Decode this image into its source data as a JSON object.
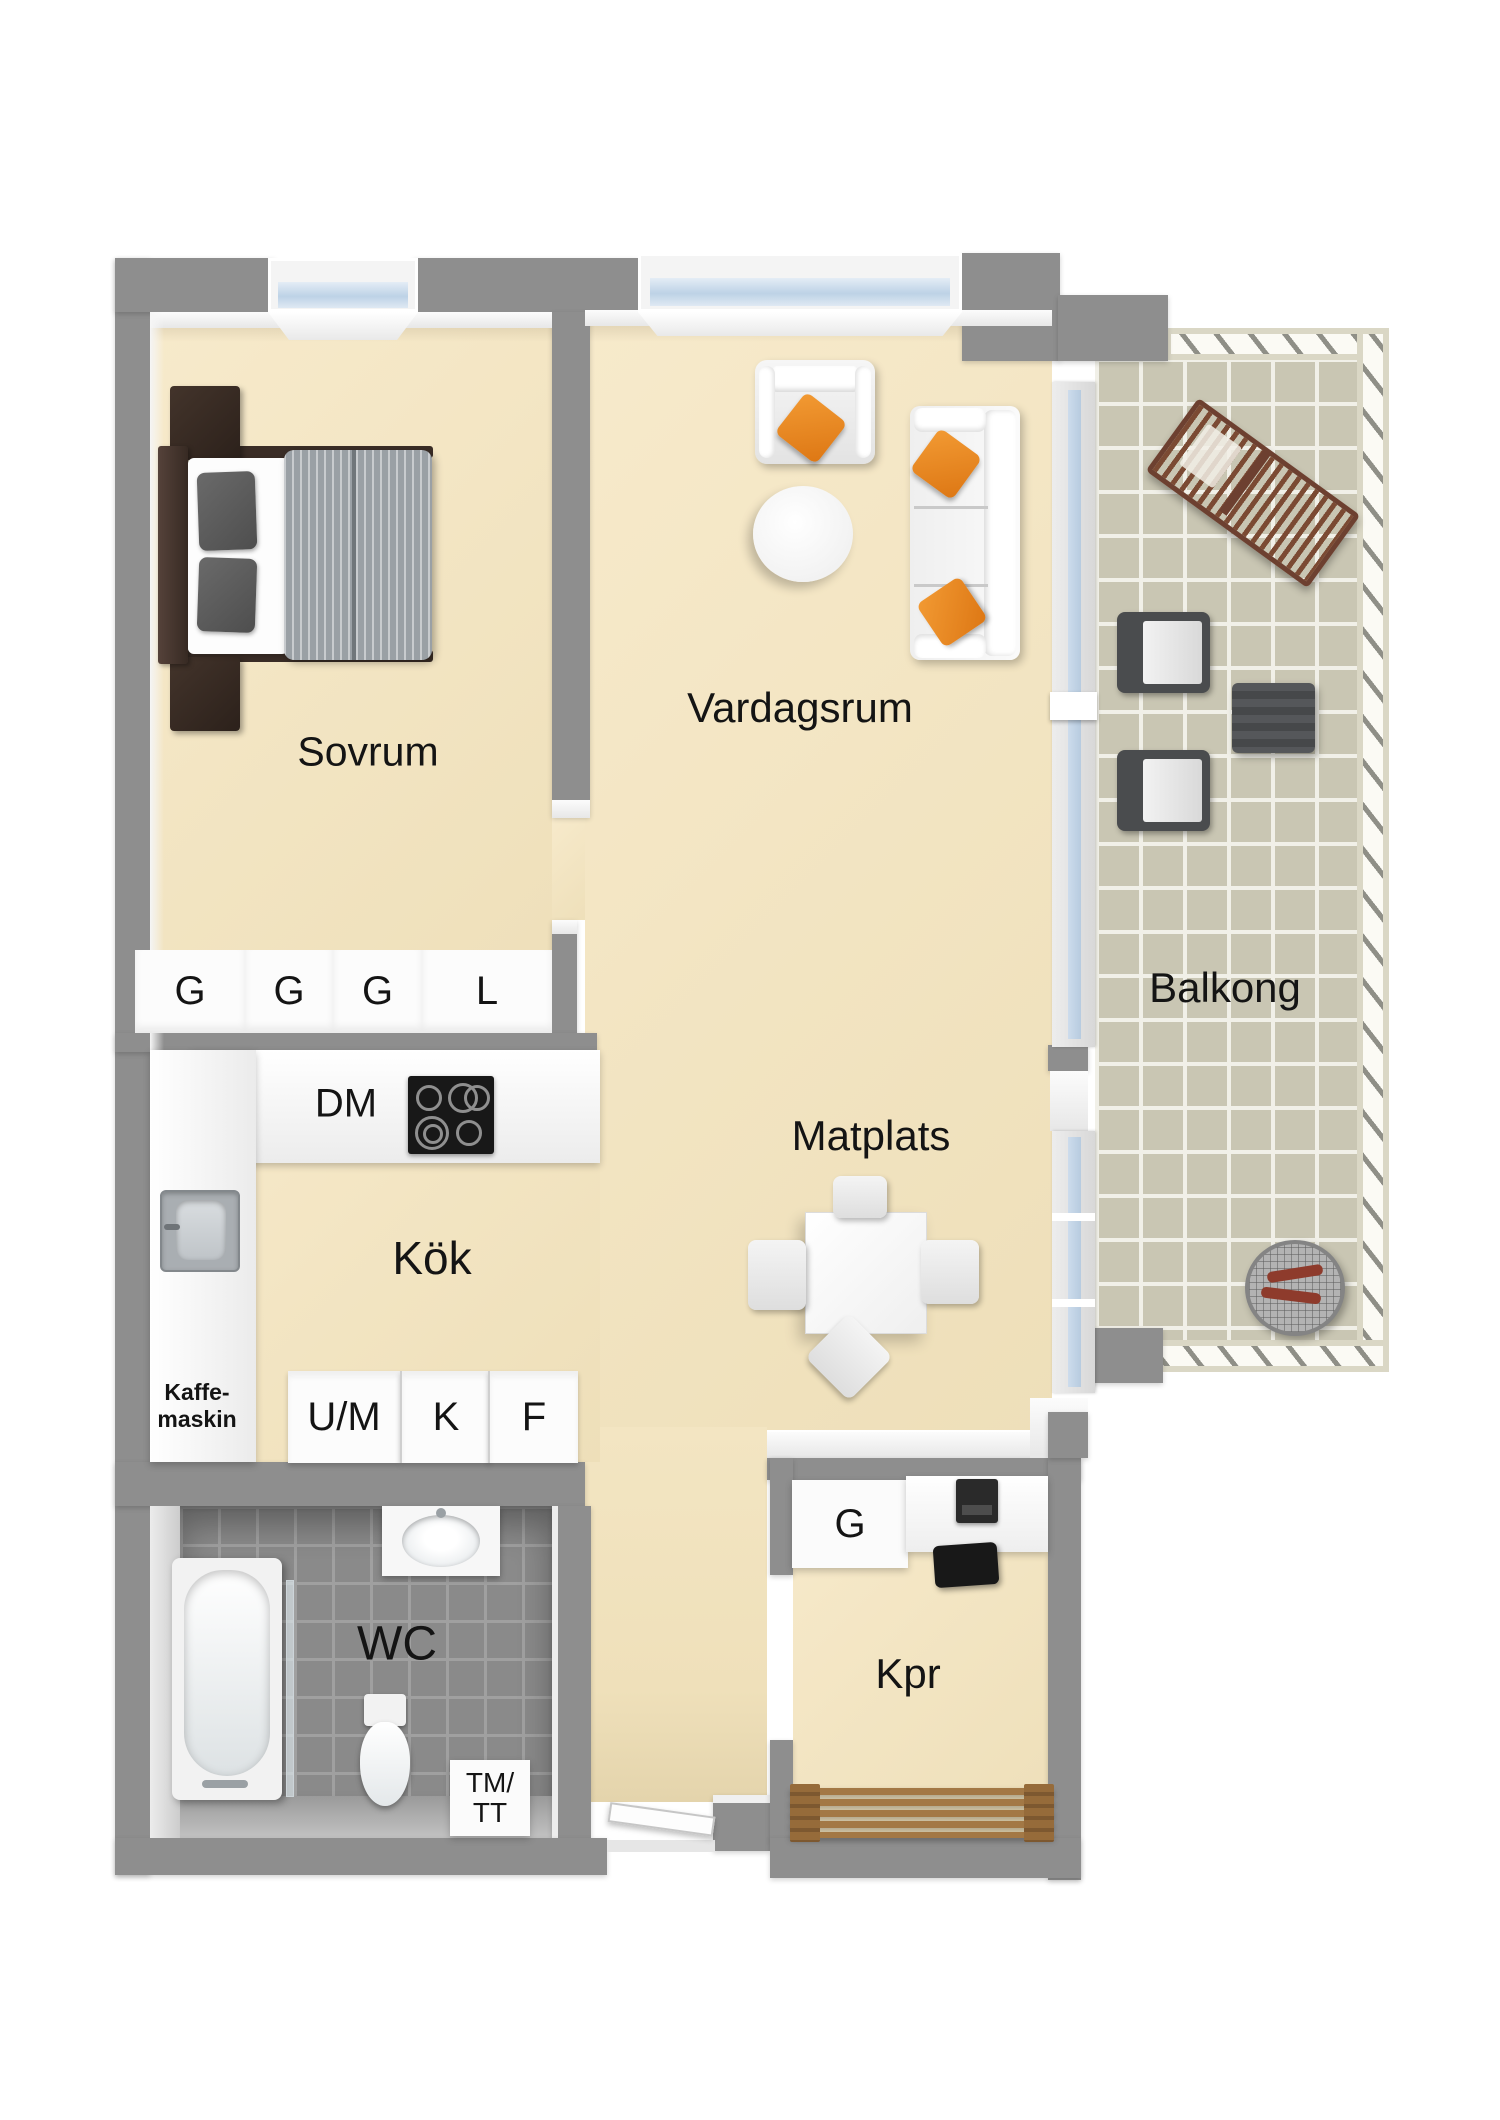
{
  "rooms": {
    "bedroom": "Sovrum",
    "living_room": "Vardagsrum",
    "balcony": "Balkong",
    "kitchen": "Kök",
    "dining": "Matplats",
    "bathroom": "WC",
    "closet_room": "Kpr"
  },
  "labels": {
    "wardrobe_row": [
      "G",
      "G",
      "G",
      "L"
    ],
    "dishwasher": "DM",
    "kitchen_units": [
      "U/M",
      "K",
      "F"
    ],
    "coffee_machine": [
      "Kaffe-",
      "maskin"
    ],
    "washer_dryer": [
      "TM/",
      "TT"
    ],
    "kpr_wardrobe": "G"
  },
  "colors": {
    "wall_gray": "#8e8e8e",
    "floor_beige": "#f3e5c2",
    "wc_tile_gray": "#8a8a8a",
    "balcony_tile": "#c9c6b3",
    "pillow_orange": "#e8831d",
    "wood_brown": "#7b4a33",
    "window_glass": "#c5d6e8"
  }
}
